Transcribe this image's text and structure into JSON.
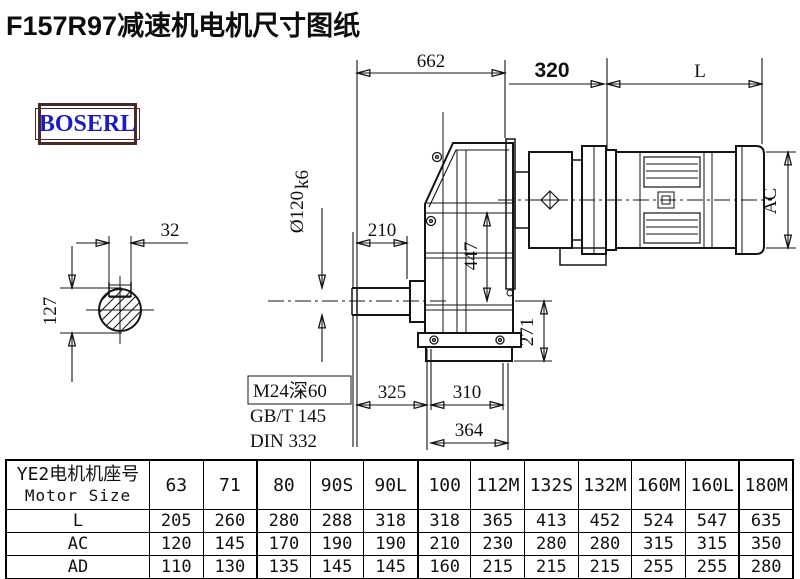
{
  "title": "F157R97减速机电机尺寸图纸",
  "logo": "BOSERL",
  "drawing": {
    "d662": "662",
    "d320": "320",
    "dL": "L",
    "d32": "32",
    "d127": "127",
    "shaft_dia": "Ø120",
    "shaft_tol": "k6",
    "d210": "210",
    "d447": "447",
    "d271": "271",
    "d325": "325",
    "d310": "310",
    "d364": "364",
    "dAC": "AC",
    "tap": "M24深60",
    "std_gb": "GB/T 145",
    "std_din": "DIN 332"
  },
  "table": {
    "header_cn": "YE2电机机座号",
    "header_en": "Motor Size",
    "columns": [
      "63",
      "71",
      "80",
      "90S",
      "90L",
      "100",
      "112M",
      "132S",
      "132M",
      "160M",
      "160L",
      "180M"
    ],
    "rows": [
      {
        "label": "L",
        "values": [
          "205",
          "260",
          "280",
          "288",
          "318",
          "318",
          "365",
          "413",
          "452",
          "524",
          "547",
          "635"
        ]
      },
      {
        "label": "AC",
        "values": [
          "120",
          "145",
          "170",
          "190",
          "190",
          "210",
          "230",
          "280",
          "280",
          "315",
          "315",
          "350"
        ]
      },
      {
        "label": "AD",
        "values": [
          "110",
          "130",
          "135",
          "145",
          "145",
          "160",
          "215",
          "215",
          "215",
          "255",
          "255",
          "280"
        ]
      }
    ]
  }
}
